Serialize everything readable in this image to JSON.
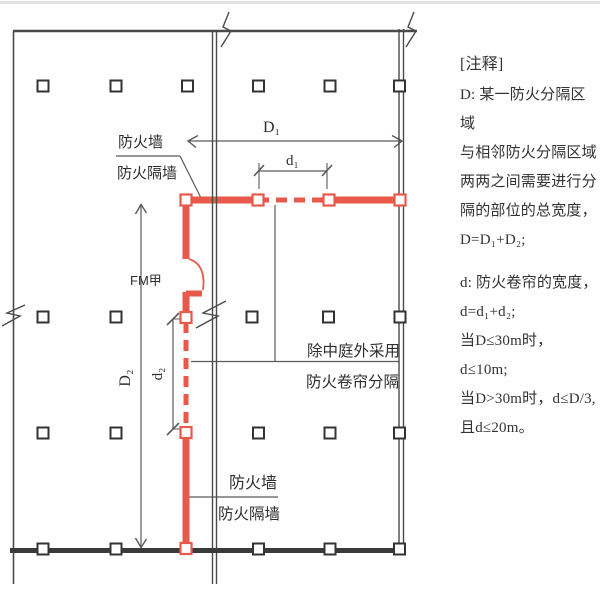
{
  "notes": {
    "header": "[注释]",
    "lines": [
      "D: 某一防火分隔区域",
      "与相邻防火分隔区域",
      "两两之间需要进行分",
      "隔的部位的总宽度，",
      "D=D₁+D₂;",
      "d: 防火卷帘的宽度，",
      "d=d₁+d₂;",
      "当D≤30m时，d≤10m;",
      "当D>30m时，d≤D/3,",
      "且d≤20m。"
    ]
  },
  "diagram": {
    "labels": {
      "fire_wall": "防火墙",
      "fire_partition_wall": "防火隔墙",
      "dim_D1": "D₁",
      "dim_d1": "d₁",
      "dim_D2": "D₂",
      "dim_d2": "d₂",
      "fire_door": "FM甲",
      "curtain_note_line1": "除中庭外采用",
      "curtain_note_line2": "防火卷帘分隔"
    },
    "colors": {
      "fire_wall_red": "#e8594b",
      "line_dark": "#4a4a4a"
    }
  }
}
